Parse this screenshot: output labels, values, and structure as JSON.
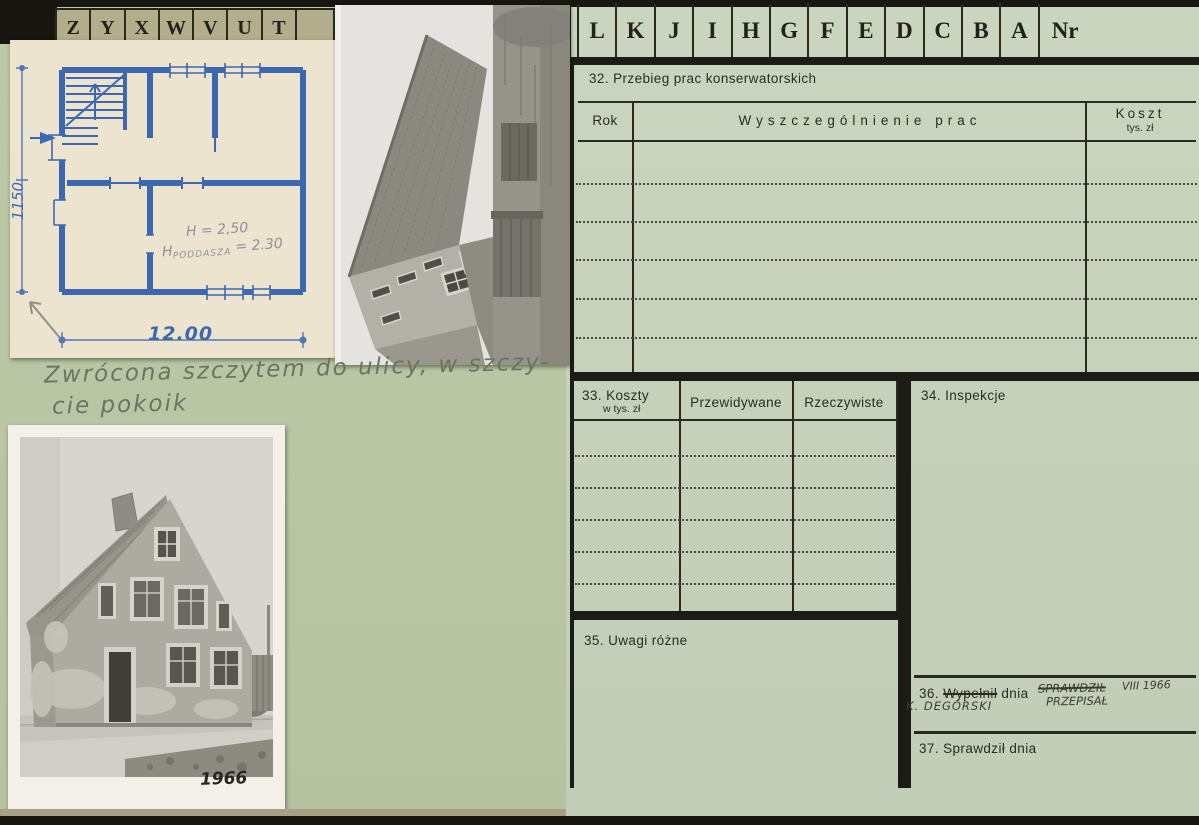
{
  "tabs": {
    "left": [
      "Z",
      "Y",
      "X",
      "W",
      "V",
      "U",
      "T"
    ],
    "right": [
      "L",
      "K",
      "J",
      "I",
      "H",
      "G",
      "F",
      "E",
      "D",
      "C",
      "B",
      "A",
      "Nr"
    ]
  },
  "form": {
    "s32_title": "32. Przebieg prac konserwatorskich",
    "s32_col_rok": "Rok",
    "s32_col_works": "Wyszczególnienie prac",
    "s32_col_cost": "Koszt",
    "s32_col_cost_unit": "tys. zł",
    "s33_title": "33. Koszty",
    "s33_subtitle": "w tys. zł",
    "s33_col_expected": "Przewidywane",
    "s33_col_actual": "Rzeczywiste",
    "s34_title": "34. Inspekcje",
    "s35_title": "35. Uwagi różne",
    "s36_num": "36.",
    "s36_word_struck": "Wypełnił",
    "s36_word_rest": "dnia",
    "s37_title": "37. Sprawdził dnia"
  },
  "handwriting": {
    "note_line1": "Zwrócona szczytem do ulicy, w szczy-",
    "note_line2": "cie pokoik",
    "s36_struck": "SPRAWDZIŁ",
    "s36_date": "VIII 1966",
    "s36_replaced": "PRZEPISAŁ",
    "s36_name": "K. DEGÓRSKI",
    "photo_year": "1966"
  },
  "blueprint": {
    "dim_height": "1150",
    "dim_width": "12.00",
    "pencil_line1": "H = 2,50",
    "pencil_h": "H",
    "pencil_sub": "PODDASZA",
    "pencil_value": "= 2.30"
  },
  "colors": {
    "card_right": "#c7d2bc",
    "card_left": "#b9c6a4",
    "tab_strip": "#b2ad8a",
    "ink_black": "#23221a",
    "blueprint_ink": "#3d68b0",
    "pencil": "#6c7364"
  }
}
